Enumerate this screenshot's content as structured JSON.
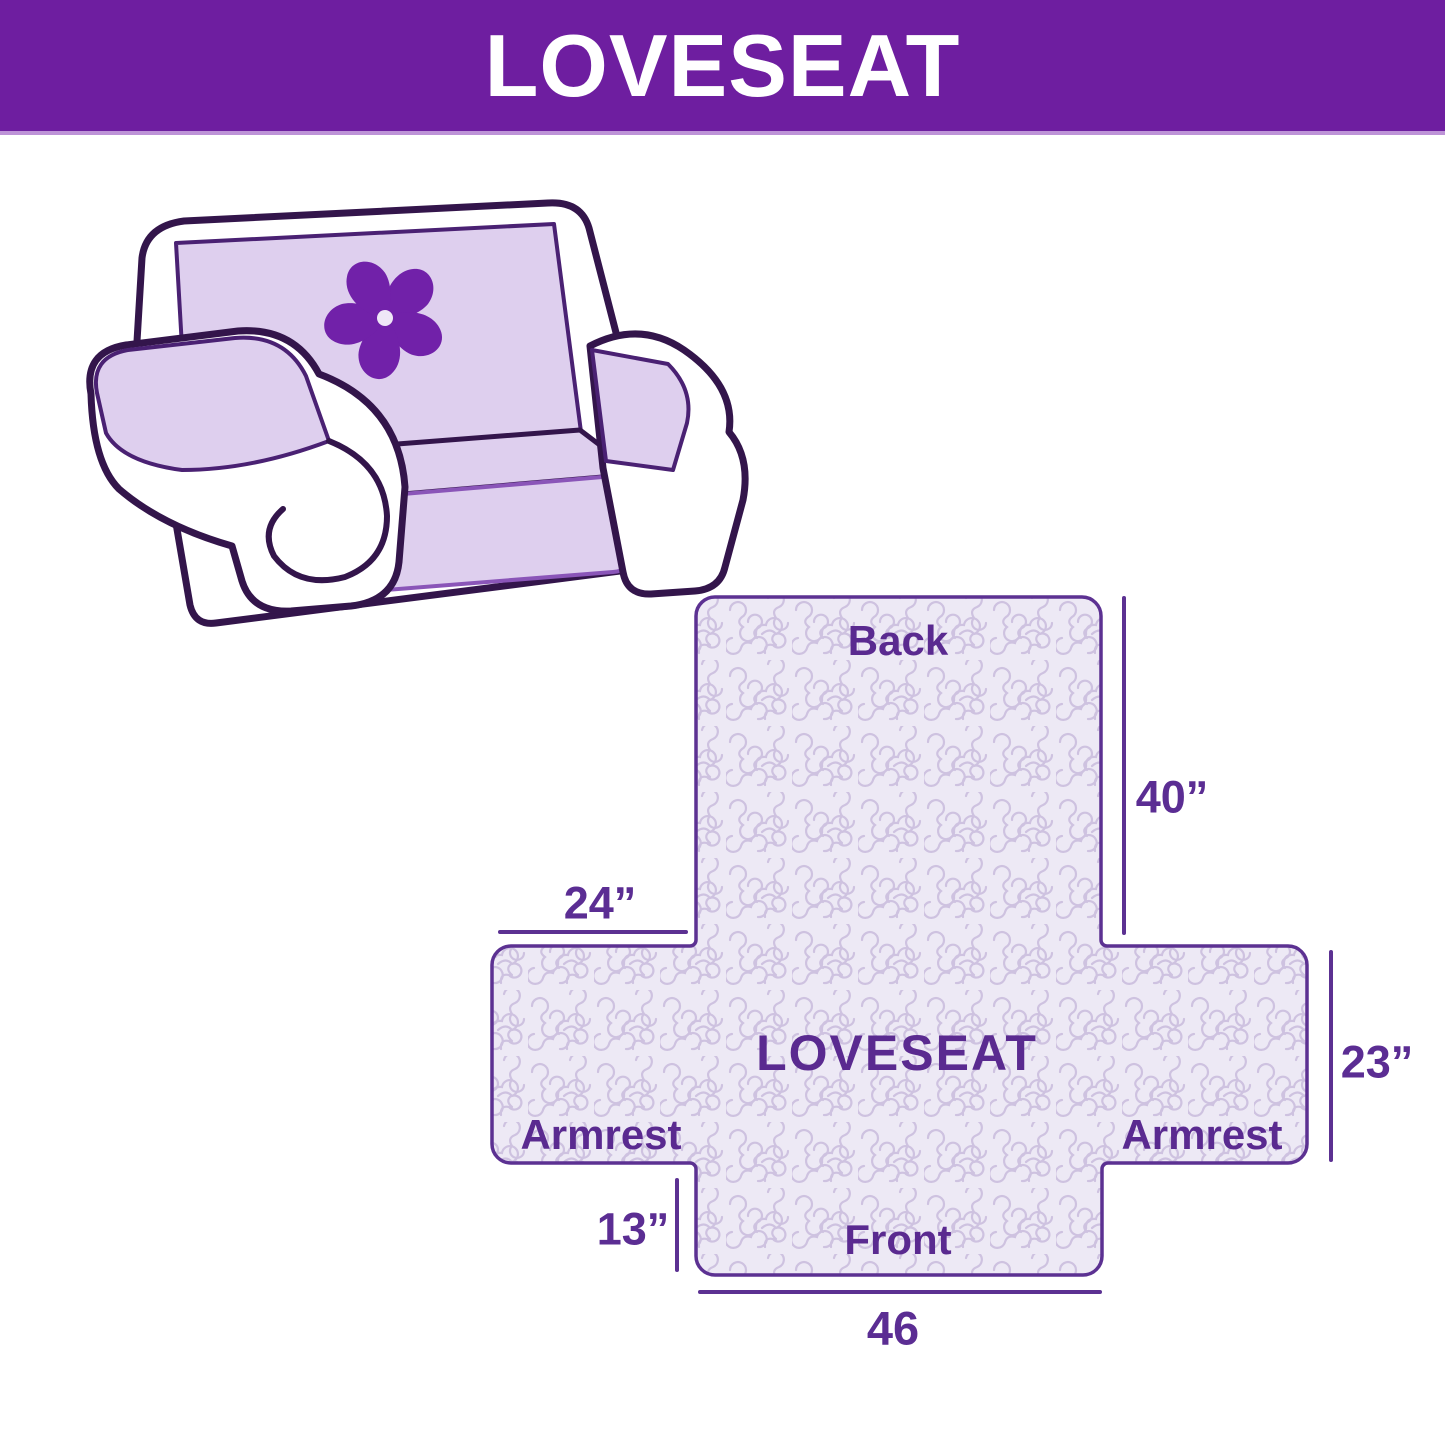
{
  "banner": {
    "title": "LOVESEAT"
  },
  "sofa": {
    "description": "Loveseat sofa line illustration with quilted lavender slipcover",
    "logo_icon": "pinwheel"
  },
  "diagram": {
    "center_label": "LOVESEAT",
    "sections": {
      "back": "Back",
      "front": "Front",
      "armrest_left": "Armrest",
      "armrest_right": "Armrest"
    },
    "dimensions": {
      "back_height": "40”",
      "armrest_top_width": "24”",
      "armrest_side_height": "23”",
      "front_skirt_height": "13”",
      "front_width": "46"
    }
  },
  "colors": {
    "banner_bg": "#6E1EA0",
    "banner_text": "#FFFFFF",
    "diagram_outline": "#5C3192",
    "diagram_fill": "#EDE9F5",
    "quilt_pattern": "#CEC2E0",
    "label_text": "#5A2A90",
    "cover_lavender": "#DECFEE",
    "pinwheel": "#7121A9",
    "sofa_outline": "#33154B"
  }
}
